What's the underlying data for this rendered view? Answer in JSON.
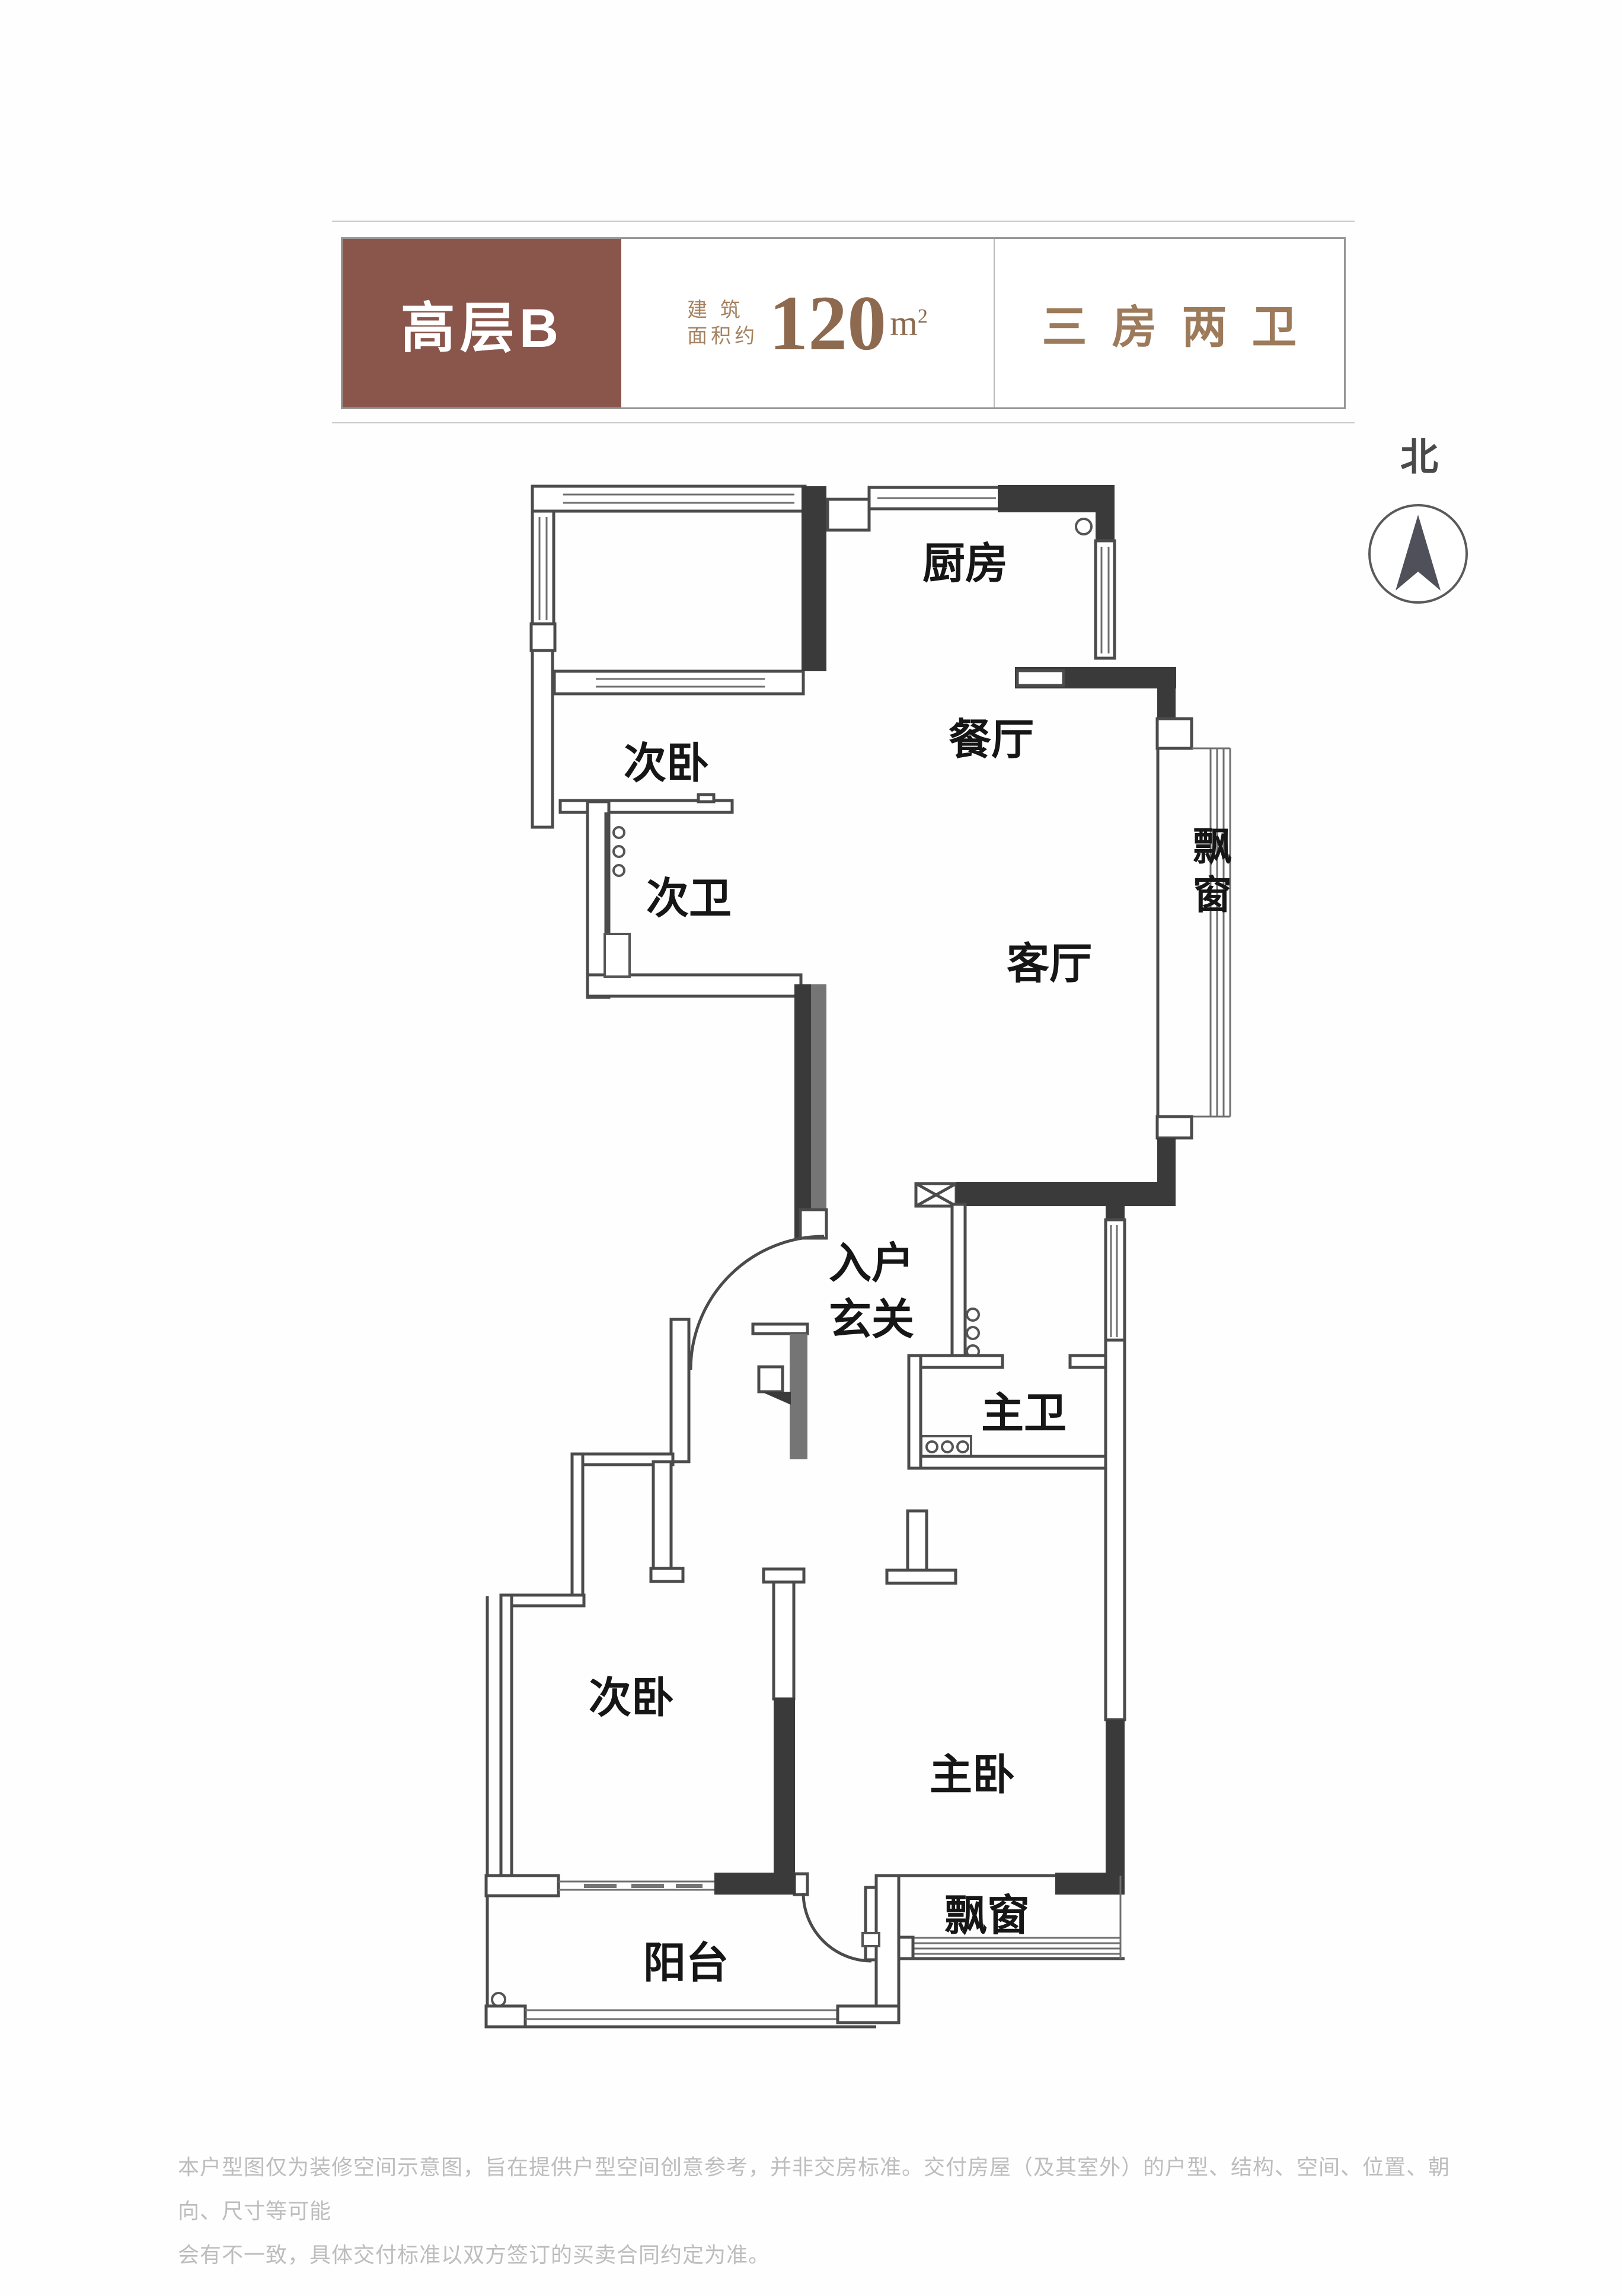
{
  "header": {
    "unit_name": "高层B",
    "area_label_line1": "建 筑",
    "area_label_line2": "面积约",
    "area_value": "120",
    "area_unit_base": "m",
    "area_exp": "2",
    "layout_type": "三房两卫"
  },
  "compass": {
    "north_label": "北"
  },
  "floor_plan": {
    "rooms": {
      "kitchen": "厨房",
      "dining": "餐厅",
      "living": "客厅",
      "bay_window_east": "飘窗",
      "bedroom_second_north": "次卧",
      "bath_second": "次卫",
      "entry_line1": "入户",
      "entry_line2": "玄关",
      "bath_master": "主卫",
      "bedroom_second_south": "次卧",
      "bedroom_master": "主卧",
      "bay_window_south": "飘窗",
      "balcony": "阳台"
    }
  },
  "footer": {
    "line1": "本户型图仅为装修空间示意图，旨在提供户型空间创意参考，并非交房标准。交付房屋（及其室外）的户型、结构、空间、位置、朝向、尺寸等可能",
    "line2": "会有不一致，具体交付标准以双方签订的买卖合同约定为准。"
  },
  "colors": {
    "header_accent": "#8a564c",
    "header_text_brown": "#9c7a5a",
    "wall_dark": "#3a3a3a",
    "wall_gray": "#757575",
    "footer_gray": "#bdbdbd"
  }
}
